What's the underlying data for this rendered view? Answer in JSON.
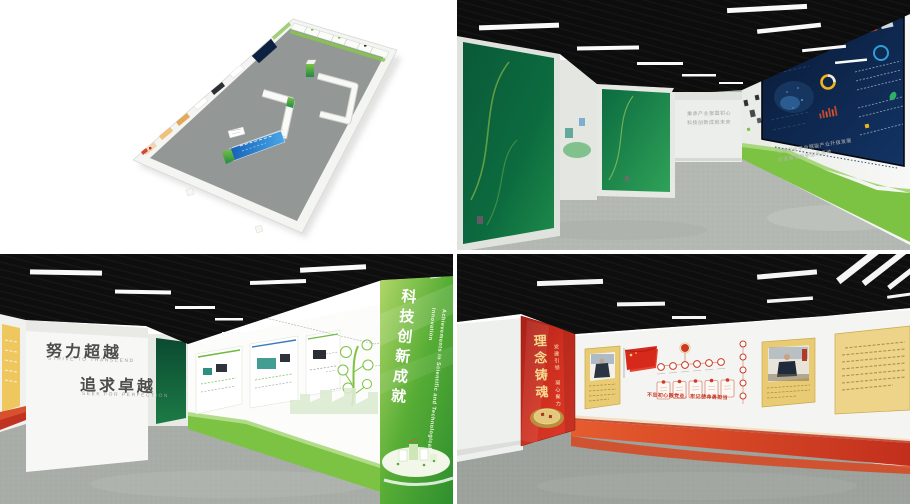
{
  "corridor": {
    "end_wall_line1": "秉承产业报国初心",
    "end_wall_line2": "科技创新成就未来",
    "screen_caption_line1": "以数字化平台赋能产业升级发展",
    "screen_caption_line2": "打造智慧创新服务高地"
  },
  "achievement_hall": {
    "slogan_line1": "努力超越",
    "slogan_line1_en": "STRIVE TO TRANSCEND",
    "slogan_line2": "追求卓越",
    "slogan_line2_en": "SEEK FOR PERFECTION",
    "green_panel_title": "科技创新成就",
    "green_panel_title_en": "Achievements in Scientific and Technological Innovation"
  },
  "party_hall": {
    "red_panel_title": "理念铸魂",
    "red_panel_subtitle": "党建引领 凝心聚力",
    "wall_slogan": "不忘初心跟党走，牢记使命勇担当"
  },
  "colors": {
    "brand_green": "#7CC243",
    "deep_green": "#0B5B3B",
    "dashboard_navy": "#0E2240",
    "party_red": "#CE3322",
    "gold": "#E9CB74",
    "ceiling_black": "#0E0E0E",
    "floor_gray": "#A7ACA7"
  }
}
